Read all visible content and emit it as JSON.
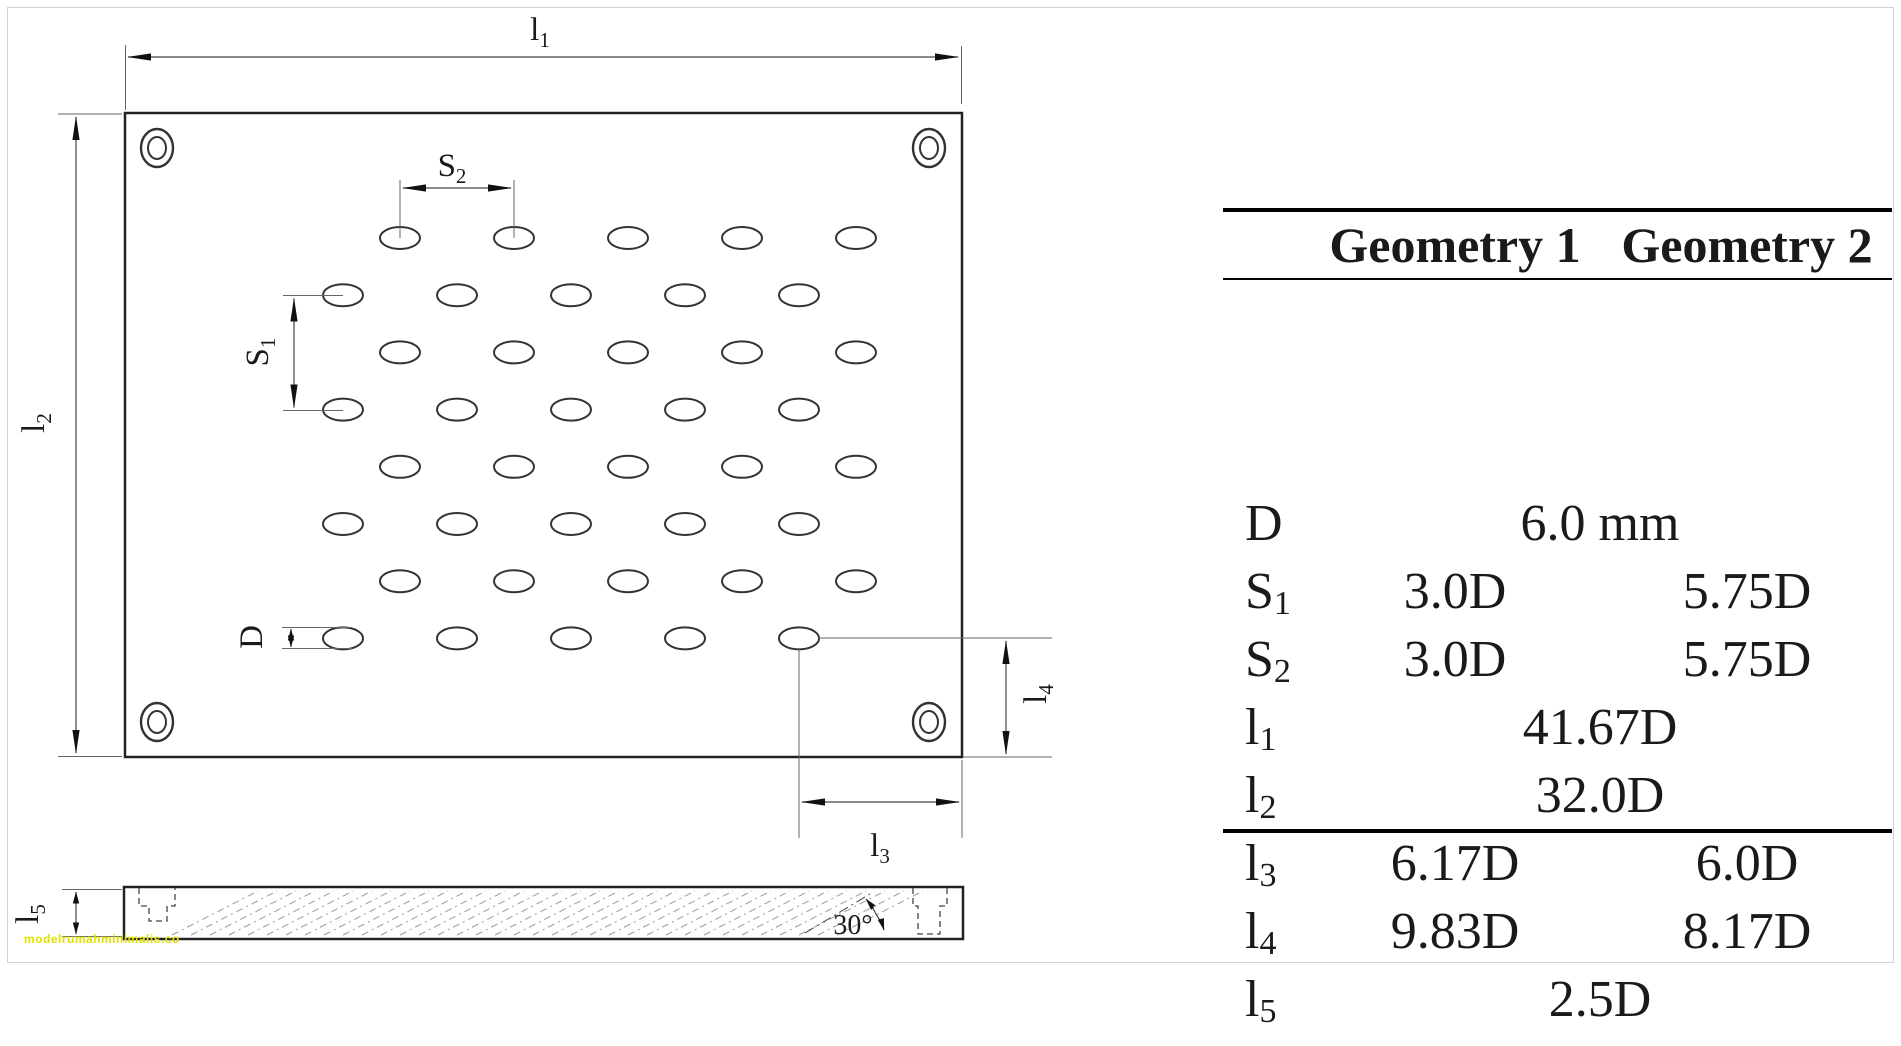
{
  "page": {
    "background": "#ffffff",
    "frame_color": "#d2d2d2",
    "line_color": "#222222",
    "thin_line_color": "#555555"
  },
  "diagram": {
    "labels": {
      "l1": {
        "base": "l",
        "sub": "1"
      },
      "l2": {
        "base": "l",
        "sub": "2"
      },
      "l3": {
        "base": "l",
        "sub": "3"
      },
      "l4": {
        "base": "l",
        "sub": "4"
      },
      "l5": {
        "base": "l",
        "sub": "5"
      },
      "s1": {
        "base": "S",
        "sub": "1"
      },
      "s2": {
        "base": "S",
        "sub": "2"
      },
      "d": {
        "base": "D",
        "sub": ""
      },
      "angle": "30°"
    },
    "holes": {
      "rows": 8,
      "cols": 5,
      "first_row_y": 238,
      "row_spacing": 57.2,
      "odd_row_x": 400,
      "even_row_x": 343,
      "col_spacing": 114,
      "rx": 20,
      "ry": 11
    },
    "hatch": {
      "x_start": 172,
      "x_end": 848,
      "spacing": 19,
      "run": 86,
      "y_bottom": 935,
      "y_top": 891
    },
    "watermark": {
      "text": "modelrumahminimalis.co",
      "color": "#e2e200"
    }
  },
  "table": {
    "headers": [
      {
        "label": "Geometry 1"
      },
      {
        "label": "Geometry 2"
      }
    ],
    "rows": [
      {
        "label": {
          "base": "D",
          "sub": ""
        },
        "span": "6.0 mm"
      },
      {
        "label": {
          "base": "S",
          "sub": "1"
        },
        "g1": "3.0D",
        "g2": "5.75D"
      },
      {
        "label": {
          "base": "S",
          "sub": "2"
        },
        "g1": "3.0D",
        "g2": "5.75D"
      },
      {
        "label": {
          "base": "l",
          "sub": "1"
        },
        "span": "41.67D"
      },
      {
        "label": {
          "base": "l",
          "sub": "2"
        },
        "span": "32.0D"
      },
      {
        "label": {
          "base": "l",
          "sub": "3"
        },
        "g1": "6.17D",
        "g2": "6.0D"
      },
      {
        "label": {
          "base": "l",
          "sub": "4"
        },
        "g1": "9.83D",
        "g2": "8.17D"
      },
      {
        "label": {
          "base": "l",
          "sub": "5"
        },
        "span": "2.5D"
      }
    ]
  }
}
